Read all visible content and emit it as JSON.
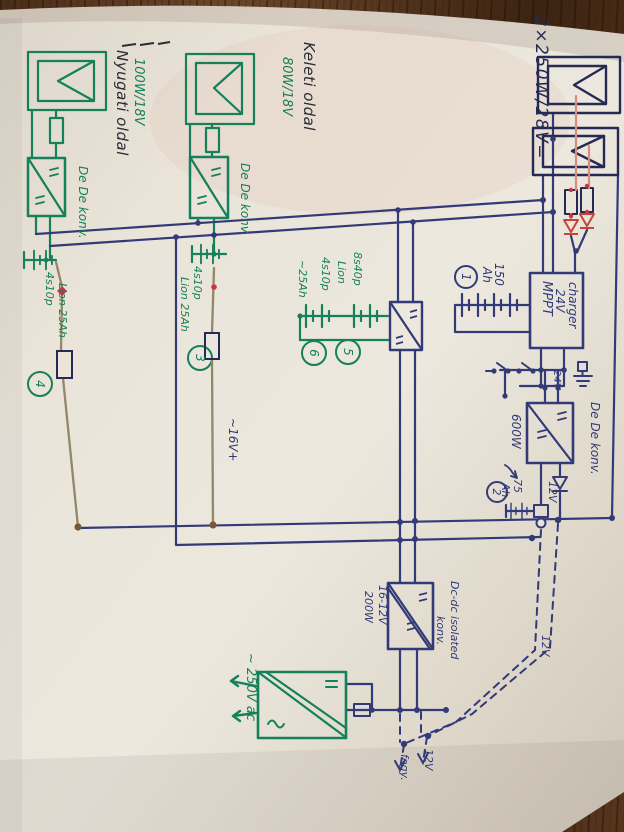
{
  "colors": {
    "wood": "#462c18",
    "wood_light": "#6b4629",
    "paper": "#e9e4da",
    "blue_ink": "#323a78",
    "dark_ink": "#252a55",
    "green_ink": "#15805a",
    "red_ink": "#c44536",
    "red_light": "#d98d82",
    "wire_thin": "#93866a",
    "brown_dot": "#7a5636"
  },
  "labels": {
    "panels_right": "2×250W/28V=",
    "east_side": "Keleti oldal",
    "east_power": "80W/18V",
    "west_side": "Nyugati oldal",
    "west_power": "100W/18V",
    "dcdc_west": "De De konv.",
    "dcdc_east": "De De konv.",
    "dcdc_600": "De De konv.",
    "mppt_line1": "MPPT",
    "mppt_line2": "24V",
    "mppt_line3": "charger",
    "bat1_cap": "150",
    "bat1_ah": "Ah",
    "bat1_num": "1",
    "bank_l1": "8s40p",
    "bank_l2": "Lion",
    "bank_l3": "4s10p",
    "bank_l4": "~25Ah",
    "bank_num5": "5",
    "bank_num6": "6",
    "bat3_l1": "4s10p",
    "bat3_l2": "Lion 25Ah",
    "bat3_num": "3",
    "bat4_l1": "4s10p",
    "bat4_l2": "Lion 25Ah",
    "bat4_num": "4",
    "v24": "24V",
    "w600": "600W",
    "v12_out": "12V",
    "bat2_cap": "75",
    "bat2_ah": "Ah",
    "bat2_num": "2",
    "v16": "~16V+",
    "iso_l1": "Dc-dc isolated",
    "iso_l2": "konv.",
    "iso_in": "16-12V",
    "iso_w": "200W",
    "v12_right": "12V",
    "inv_out": "~ 250V ac",
    "load_12v": "12V",
    "load_fogy": "fogy."
  }
}
